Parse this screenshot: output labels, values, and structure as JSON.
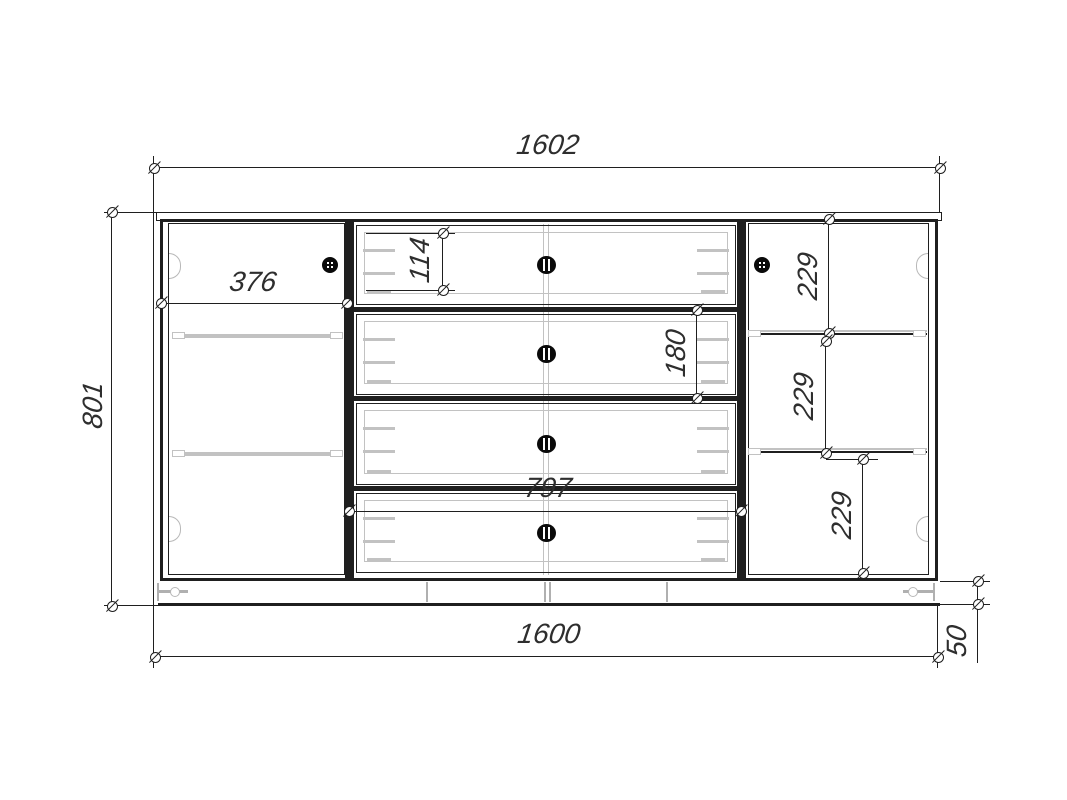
{
  "drawing": {
    "type": "furniture-front-elevation-technical-drawing",
    "labels": {
      "overall_width": "1602",
      "overall_height": "801",
      "left_door_width": "376",
      "top_drawer_height": "114",
      "second_drawer_height": "180",
      "drawer_section_width": "797",
      "right_gap_top": "229",
      "right_gap_middle": "229",
      "right_gap_bottom": "229",
      "carcass_width": "1600",
      "plinth_height": "50"
    },
    "colors": {
      "line": "#1f1f1f",
      "detail_gray": "#c2c2c2",
      "background": "#ffffff",
      "dimension_text": "#2e2e2e"
    }
  }
}
